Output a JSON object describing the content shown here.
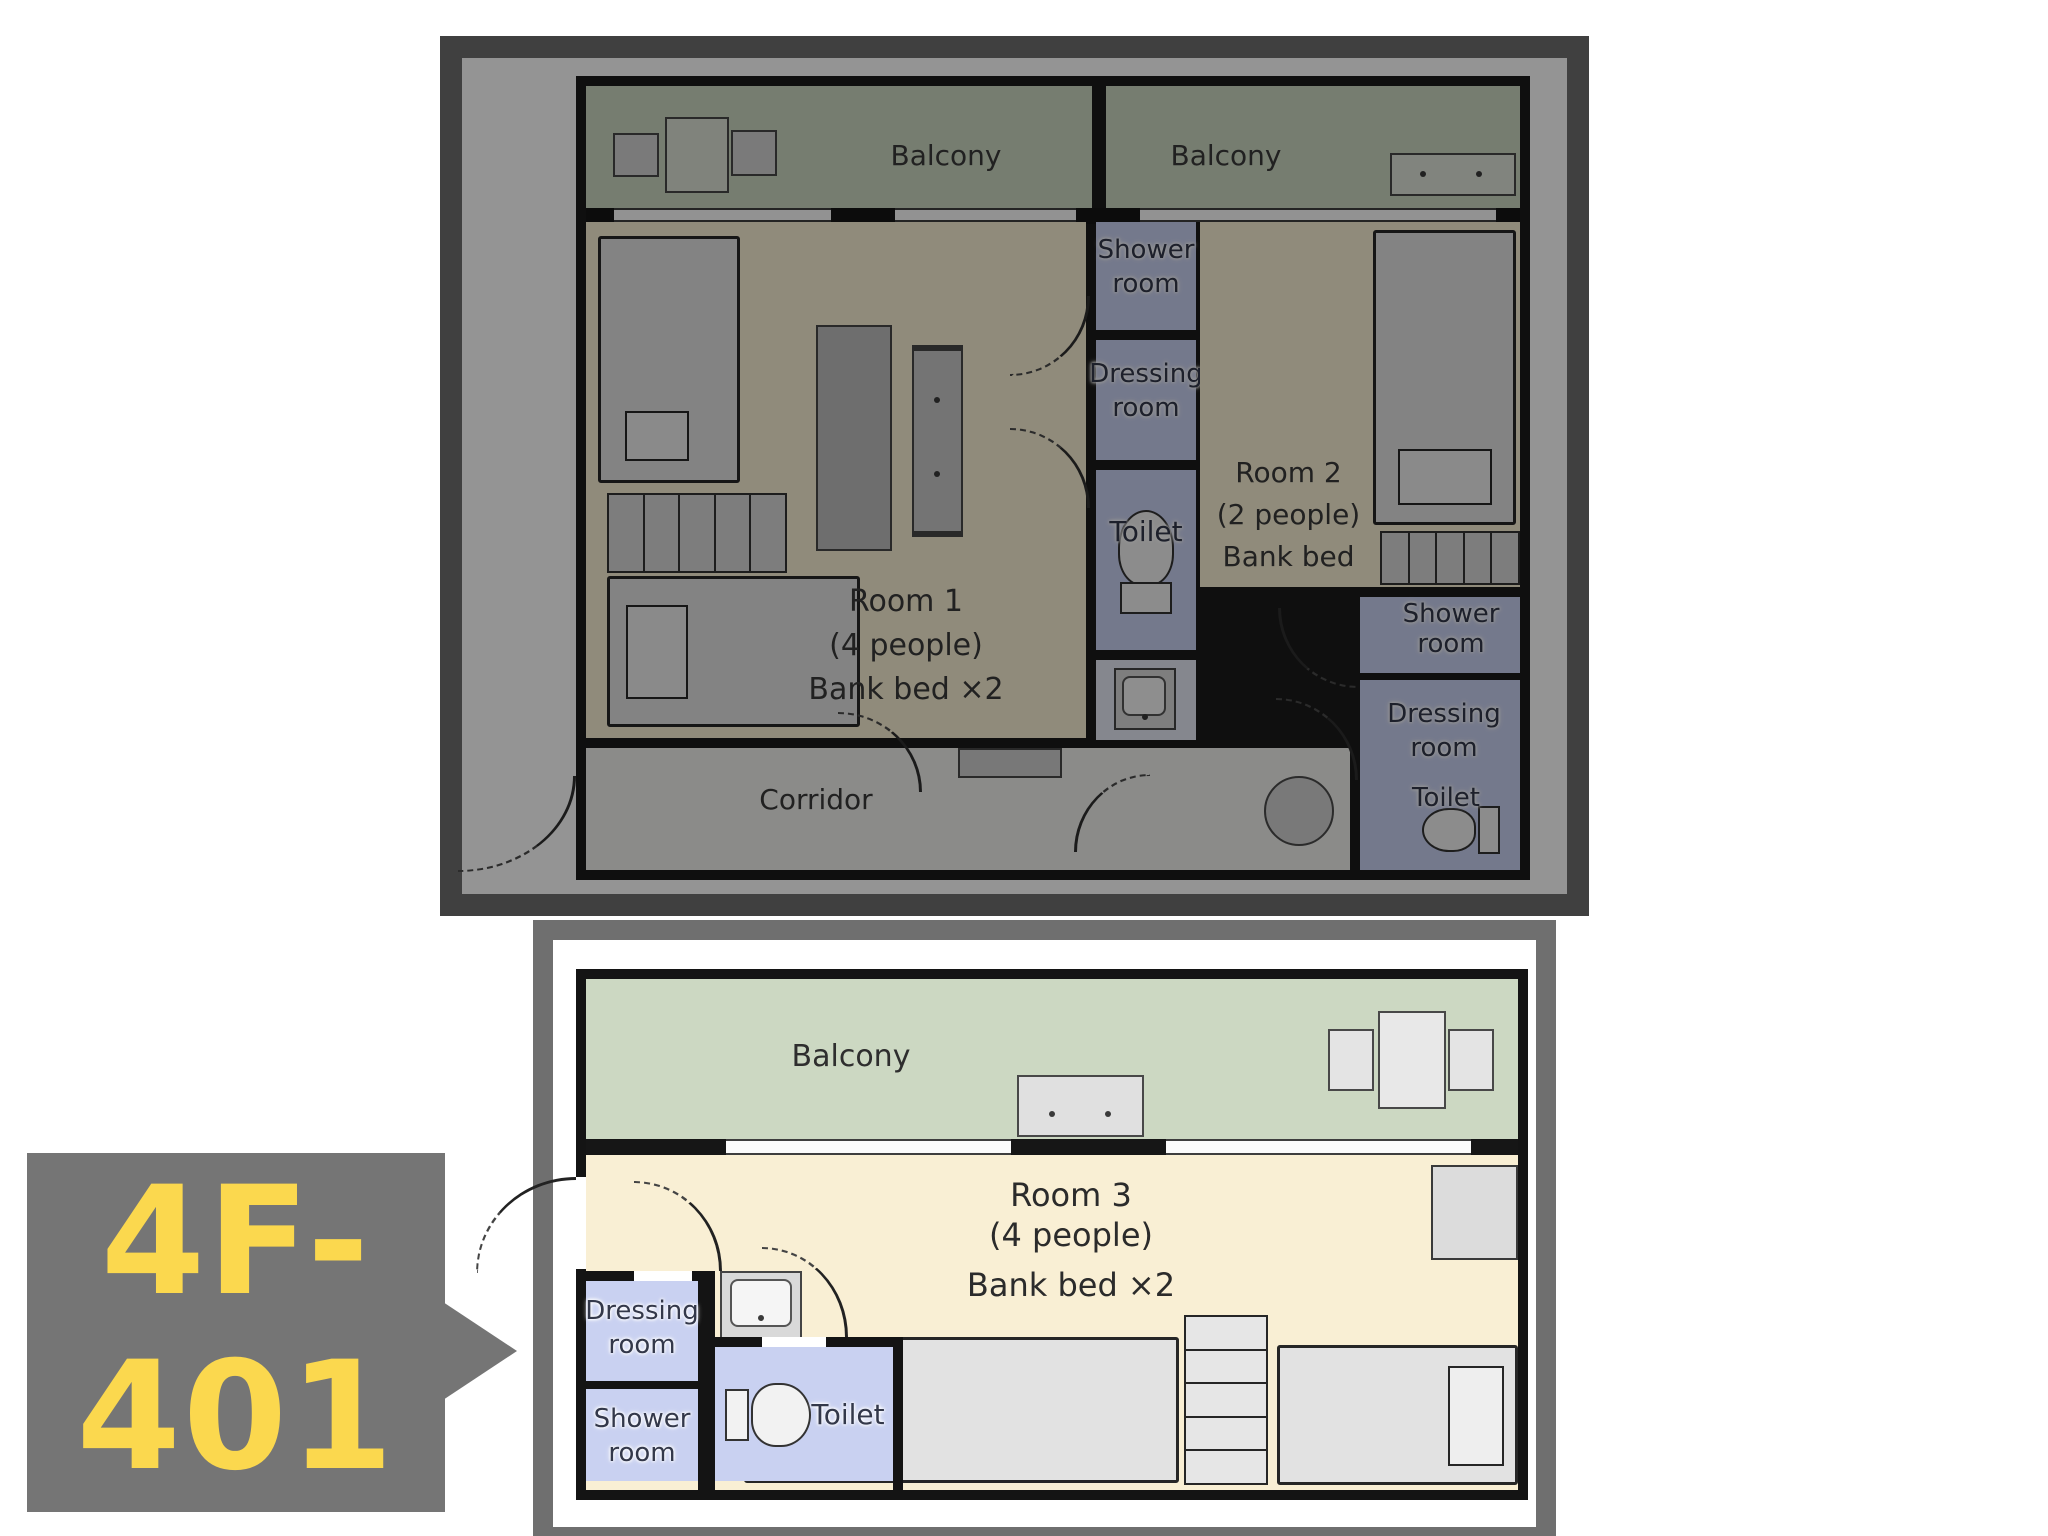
{
  "callout": {
    "label": "4F-401",
    "line1": "4F-",
    "line2": "401",
    "text_color": "#fbd84e",
    "bg_color": "#757575"
  },
  "upper_plan": {
    "state": "dimmed",
    "balcony_left": "Balcony",
    "balcony_right": "Balcony",
    "shower_center": [
      "Shower",
      "room"
    ],
    "dressing_center": [
      "Dressing",
      "room"
    ],
    "toilet_center": "Toilet",
    "room1": [
      "Room 1",
      "(4 people)",
      "Bank bed ×2"
    ],
    "room2": [
      "Room 2",
      "(2 people)",
      "Bank bed"
    ],
    "shower_right": [
      "Shower",
      "room"
    ],
    "dressing_right": [
      "Dressing",
      "room"
    ],
    "toilet_right": "Toilet",
    "corridor": "Corridor"
  },
  "lower_plan": {
    "state": "highlighted",
    "balcony": "Balcony",
    "room3": [
      "Room 3",
      "(4 people)",
      "Bank bed ×2"
    ],
    "dressing": [
      "Dressing",
      "room"
    ],
    "shower": [
      "Shower",
      "room"
    ],
    "toilet": "Toilet"
  },
  "colors": {
    "wall": "#1b1b1b",
    "balcony_floor": "#ccd8c2",
    "room_floor": "#f9efd4",
    "wet_room_floor": "#c9d1f1",
    "corridor_floor": "#efefed",
    "frame": "#6f6f6f",
    "callout_bg": "#757575",
    "callout_text": "#fbd84e"
  }
}
